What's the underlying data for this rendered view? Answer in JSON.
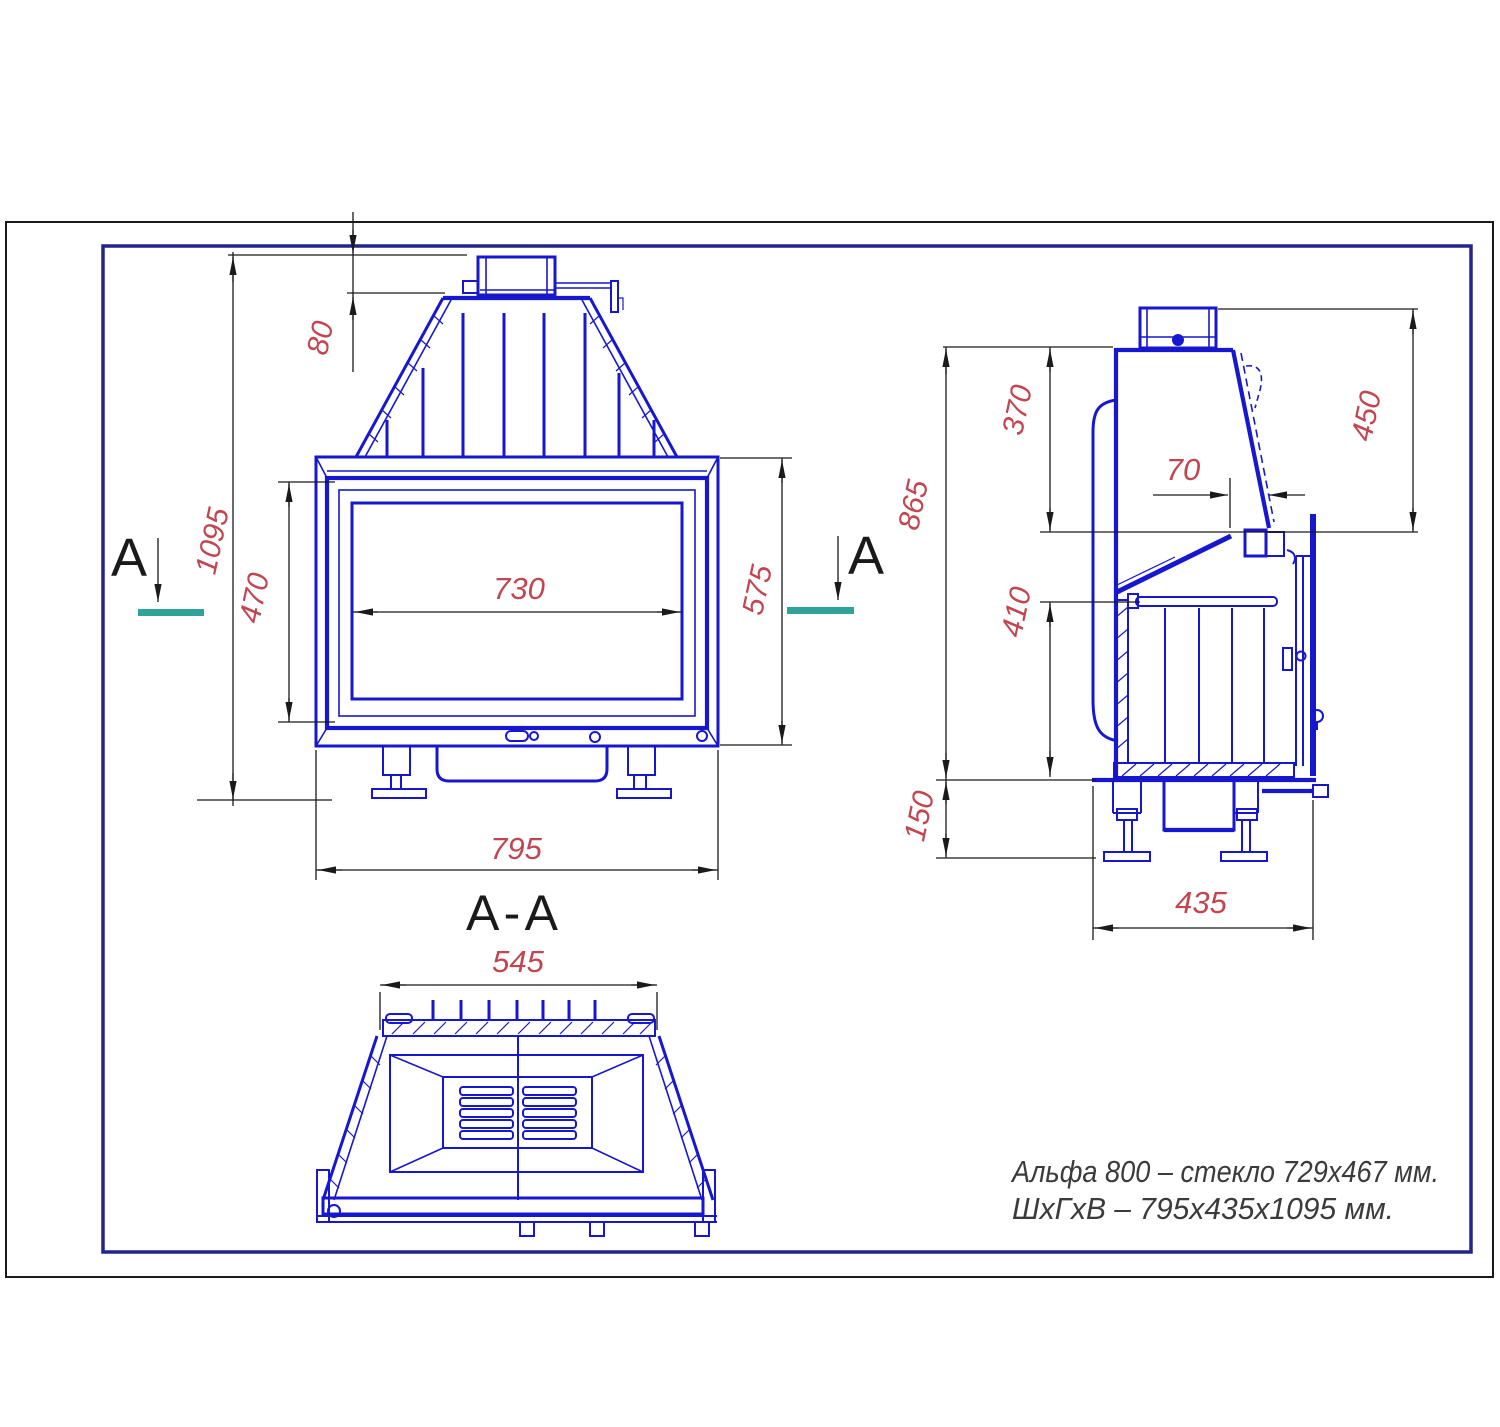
{
  "sheet": {
    "note_line1": "Альфа 800 – стекло 729x467 мм.",
    "note_line2": "ШхГхВ – 795x435x1095 мм.",
    "section_label": "A-A",
    "section_marker_left": "A",
    "section_marker_right": "A"
  },
  "dimensions": {
    "front_view": [
      {
        "feature": "flue-collar-height",
        "value": "80"
      },
      {
        "feature": "overall-height",
        "value": "1095"
      },
      {
        "feature": "door-opening-height",
        "value": "470"
      },
      {
        "feature": "glass-width",
        "value": "730"
      },
      {
        "feature": "facade-height",
        "value": "575"
      },
      {
        "feature": "overall-width",
        "value": "795"
      }
    ],
    "side_view": [
      {
        "feature": "hood-section-height",
        "value": "370"
      },
      {
        "feature": "collar-to-frame-height",
        "value": "450"
      },
      {
        "feature": "glass-tilt-offset",
        "value": "70"
      },
      {
        "feature": "body-height",
        "value": "865"
      },
      {
        "feature": "firebox-height",
        "value": "410"
      },
      {
        "feature": "leg-height",
        "value": "150"
      },
      {
        "feature": "overall-depth",
        "value": "435"
      }
    ],
    "section_view": [
      {
        "feature": "hood-top-width",
        "value": "545"
      }
    ]
  },
  "colors": {
    "drawing_blue": "#1717cf",
    "dimension_red": "#c2454f",
    "line_black": "#1a1a1a",
    "border_navy": "#23238e",
    "section_teal": "#2fa39a",
    "note_gray": "#3b3b3b",
    "background": "#ffffff"
  }
}
